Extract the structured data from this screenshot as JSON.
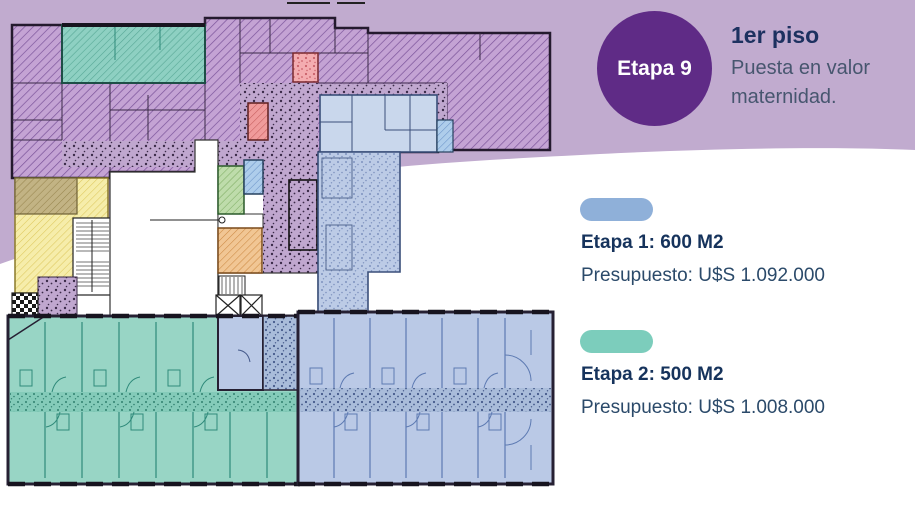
{
  "badge": {
    "label": "Etapa 9"
  },
  "header": {
    "title": "1er piso",
    "subtitle": "Puesta en valor maternidad."
  },
  "legend": {
    "items": [
      {
        "title": "Etapa 1: 600 M2",
        "budget": "Presupuesto: U$S 1.092.000",
        "swatch_color": "#8fb0d9"
      },
      {
        "title": "Etapa 2: 500 M2",
        "budget": "Presupuesto: U$S 1.008.000",
        "swatch_color": "#7ccdbc"
      }
    ]
  },
  "colors": {
    "badge_purple": "#5f2b86",
    "band_lavender": "#c1abcf",
    "title_navy": "#1d3160",
    "subtitle_gray_blue": "#47566f",
    "plan_purple_hatch": "#c4a3d4",
    "plan_blue": "#bac9e6",
    "plan_teal": "#98d5c5",
    "plan_yellow": "#f6edaa",
    "plan_tan": "#c2b384",
    "plan_green": "#bedcab",
    "plan_small_blue": "#aecdeb",
    "plan_orange": "#f1c694",
    "plan_red": "#f09b9b",
    "plan_pink": "#f4acb0"
  }
}
